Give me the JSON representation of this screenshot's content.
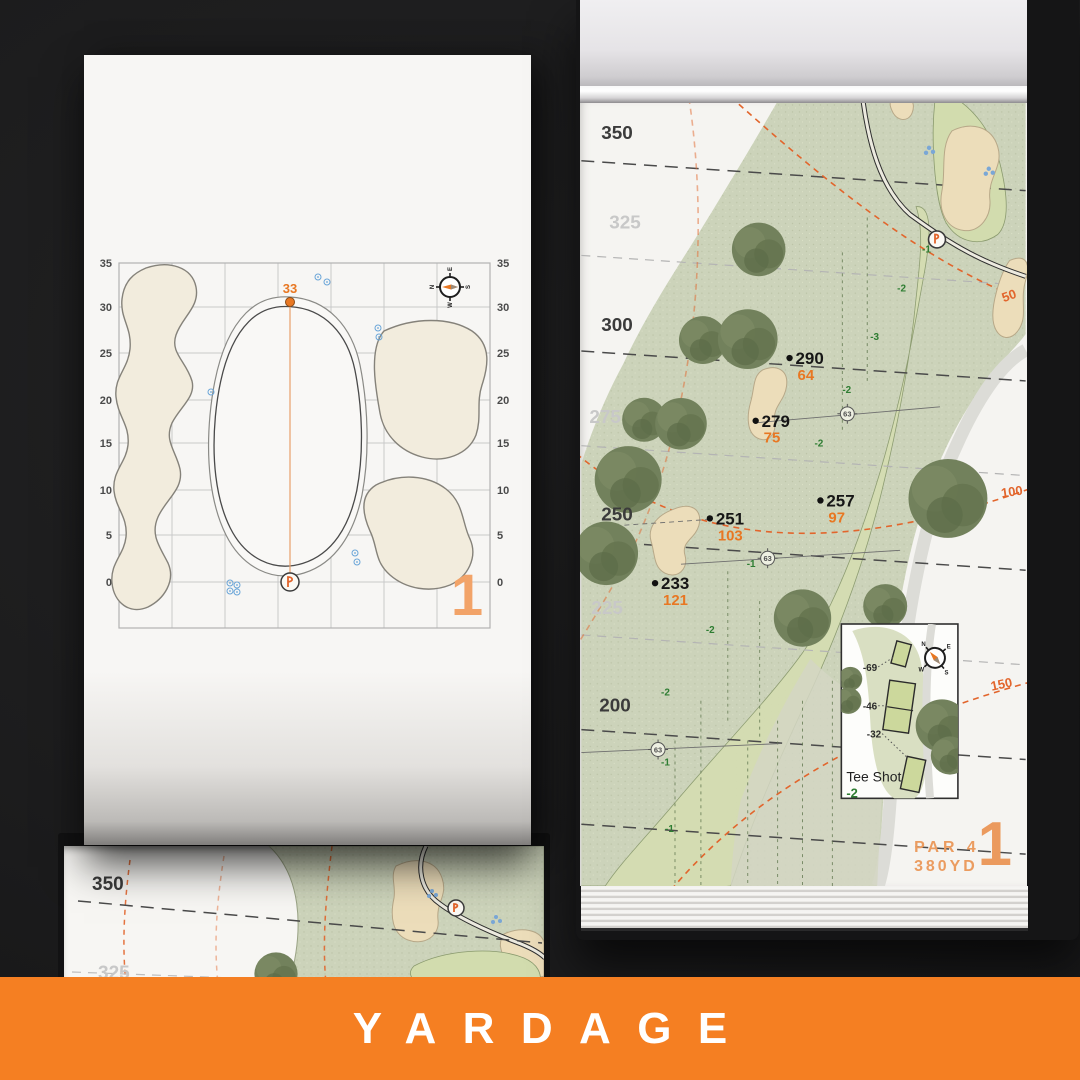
{
  "banner": {
    "label": "YARDAGE",
    "background": "#f57f22"
  },
  "compass": {
    "n": "N",
    "e": "E",
    "s": "S",
    "w": "W"
  },
  "left_page": {
    "page_number": "1",
    "pin_depth": "33",
    "axis_labels": [
      "35",
      "30",
      "25",
      "20",
      "15",
      "10",
      "5",
      "0"
    ]
  },
  "right_page": {
    "hole_number": "1",
    "par": "PAR 4",
    "yardage": "380YD",
    "distance_bands": [
      "350",
      "325",
      "300",
      "275",
      "250",
      "225",
      "200"
    ],
    "arc_labels": [
      "50",
      "100",
      "150"
    ],
    "carry_points": [
      {
        "carry": "290",
        "remain": "64"
      },
      {
        "carry": "279",
        "remain": "75"
      },
      {
        "carry": "257",
        "remain": "97"
      },
      {
        "carry": "251",
        "remain": "103"
      },
      {
        "carry": "233",
        "remain": "121"
      }
    ],
    "sprinkler_yardages": [
      "63",
      "63",
      "63"
    ],
    "elevations": [
      "-1",
      "-2",
      "-3",
      "-2",
      "-2",
      "-1",
      "-2",
      "-2",
      "-1",
      "-1"
    ],
    "tee_inset": {
      "title": "Tee Shot",
      "elevation": "-2",
      "tees": [
        "-69",
        "-46",
        "-32"
      ]
    }
  },
  "lower_left_page": {
    "distance_bands": [
      "350",
      "325"
    ]
  },
  "colors": {
    "accent_orange": "#e87722",
    "banner_orange": "#f57f22",
    "pale_orange": "#eb9c60",
    "elevation_green": "#2e7d32",
    "fairway": "#d5ddb2",
    "rough": "#ccd3ba",
    "sand": "#ecddba",
    "tree": "#6d7c57",
    "sprinkler_blue": "#6aa5d8"
  }
}
